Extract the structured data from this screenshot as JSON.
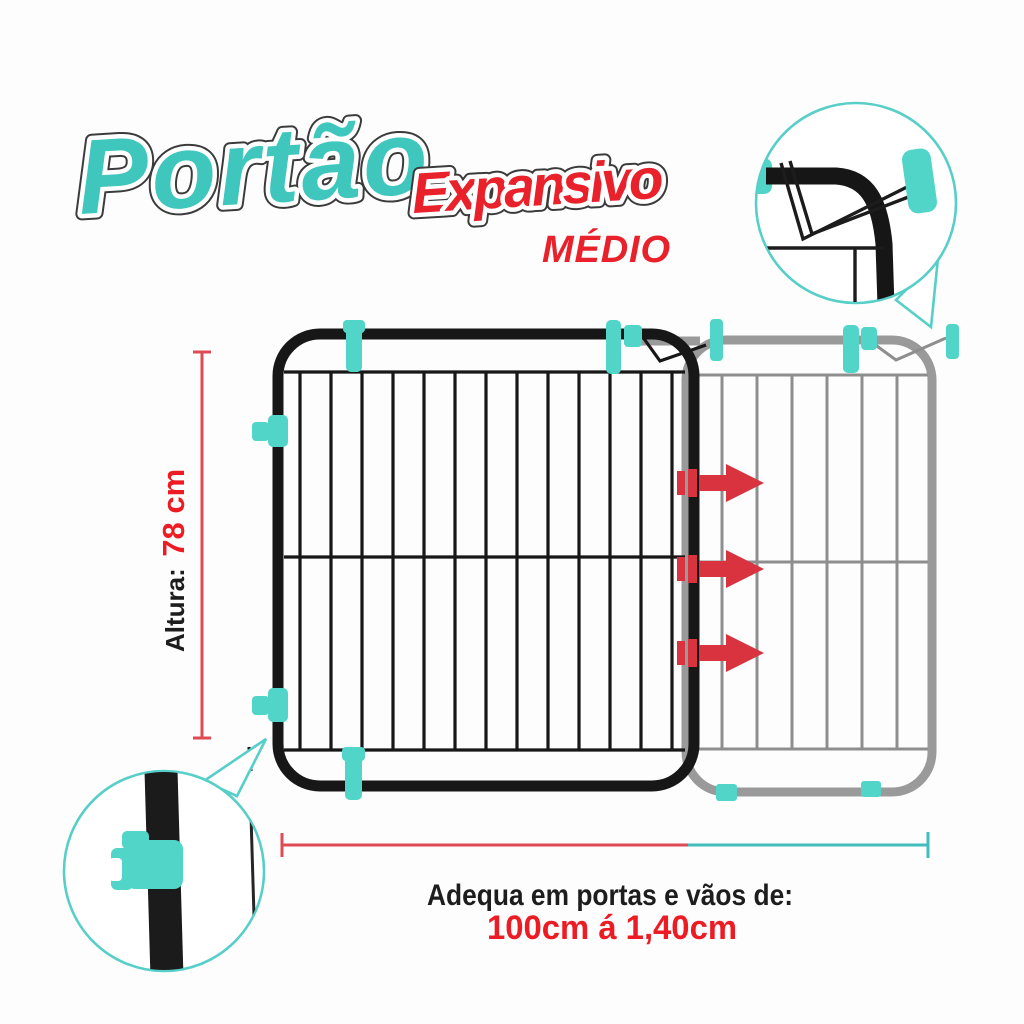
{
  "title": {
    "main": "Portão",
    "accent": "Expansivo",
    "size": "MÉDIO"
  },
  "height_dimension": {
    "label": "Altura:",
    "value": "78 cm"
  },
  "width_dimension": {
    "caption": "Adequa em portas e vãos de:",
    "range": "100cm á 1,40cm"
  },
  "colors": {
    "bg": "#fdfdfd",
    "teal": "#3fc7be",
    "teal-clip": "#52d5c9",
    "teal-stroke": "#57cfc8",
    "teal-dim": "#41bdbd",
    "red": "#e8212b",
    "red-text": "#ed1c24",
    "red-dim": "#e04a52",
    "red-arrow": "#d8333f",
    "ink": "#1d1d1d",
    "frame-black": "#171717",
    "frame-gray": "#9a9a9a",
    "wire-gray": "#8e8e8e",
    "outline-dark": "#3b3b3b"
  }
}
